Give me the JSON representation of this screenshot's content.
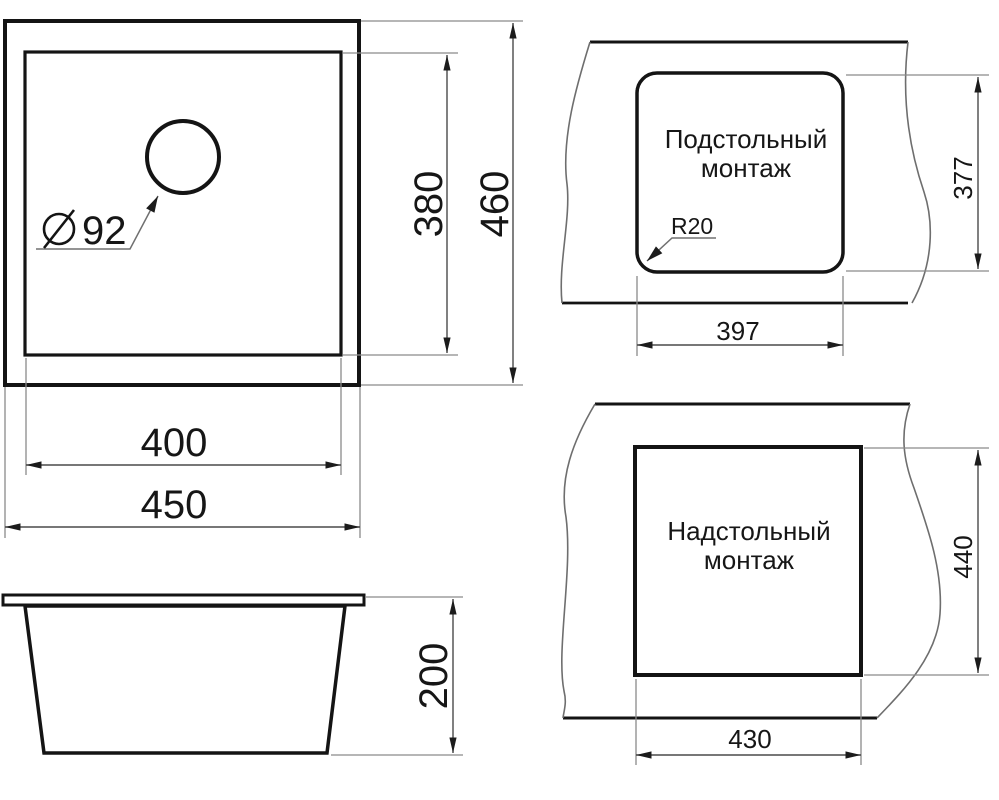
{
  "colors": {
    "bg": "#ffffff",
    "line": "#141414",
    "dim": "#4a4a4a",
    "ext": "#8a8a8a",
    "wavy": "#6e6e6e",
    "leader": "#707070",
    "arrow": "#1c1c1c",
    "text": "#161616"
  },
  "top_view": {
    "hole_diameter_symbol": "⌀",
    "hole_diameter": "92",
    "dim_inner_width": "400",
    "dim_outer_width": "450",
    "dim_inner_depth": "380",
    "dim_outer_depth": "460"
  },
  "side_view": {
    "dim_height": "200"
  },
  "undermount_view": {
    "title_line1": "Подстольный",
    "title_line2": "монтаж",
    "corner_radius": "R20",
    "dim_cutout_width": "397",
    "dim_cutout_height": "377"
  },
  "overmount_view": {
    "title_line1": "Надстольный",
    "title_line2": "монтаж",
    "dim_cutout_width": "430",
    "dim_cutout_height": "440"
  }
}
